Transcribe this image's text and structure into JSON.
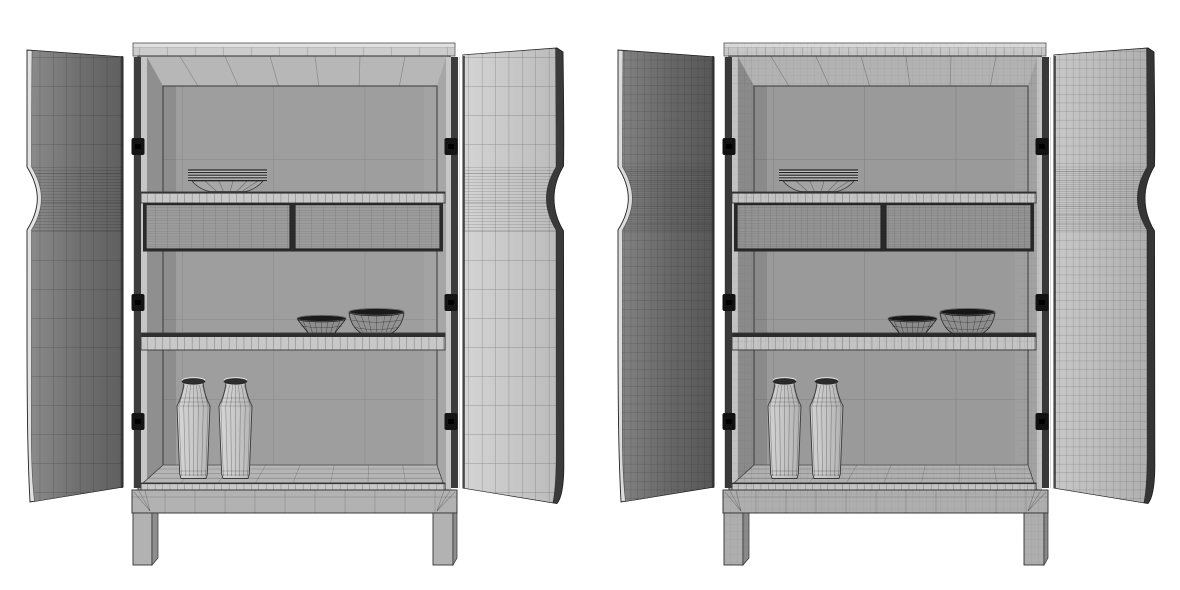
{
  "scene": {
    "title": "wireframe-3d-render-of-open-two-door-cabinet-two-views",
    "background": "#ffffff",
    "canvas": {
      "width": 1180,
      "height": 590
    },
    "objects": [
      "open two-door cabinet",
      "stacked plates",
      "small bowl",
      "large bowl",
      "two bottle vases",
      "two drawers",
      "base with legs"
    ],
    "views": [
      {
        "id": "cabA",
        "name": "cabinet-wireframe-left",
        "label": "left render (coarse wireframe)",
        "offset_x": 0,
        "mesh": {
          "door_w": 13.4,
          "door_h": 29,
          "dense_gap": 3,
          "door_line": "rgba(15,15,15,0.40)",
          "panel_w": 91.3,
          "panel_h": 80,
          "panel_line": "rgba(0,0,0,0.18)",
          "tick": 7.4,
          "cornice_tick": 28,
          "drawer_seam": 12,
          "drawer_line": "rgba(0,0,0,0.30)",
          "fine": 0
        },
        "colors": {
          "outline": "#2f2f2f",
          "cornice_top": "#e0e0e0",
          "cornice_face": "#cccccc",
          "carcass": "#b0b0b0",
          "bevel": "#b7b7b7",
          "jamb_front": "#c6c6c6",
          "reveal_left": "#8f8f8f",
          "reveal_right": "#a6a6a6",
          "panel": "#9e9e9e",
          "shelf_face": "#c8c8c8",
          "shelf_dark": "#2f2f2f",
          "drawer_face": "#9c9c9c",
          "drawer_slot": "#2b2b2b",
          "floor": "#b5b5b5",
          "edge_band": "#c9c9c9",
          "base": "#b2b2b2",
          "leg_side": "#8e8e8e",
          "hinge_gap": "#3d3d3d",
          "hinge_metal": "#141414",
          "hinge_highlight": "#d9d9d9",
          "door_left_grad": [
            "#8a8a8a",
            "#707070",
            "#5f5f5f"
          ],
          "door_right_grad": [
            "#d4d4d4",
            "#bcbcbc"
          ],
          "door_left_edge": "#e2e2e2",
          "door_right_edge": "#3a3a3a",
          "dish": "#a8a8a8",
          "dish_line": "#262626",
          "bowl_small": "#8e8e8e",
          "bowl_large": "#929292",
          "bowl_rim": "#1a1a1a",
          "vase_grad": [
            "#d6d6d6",
            "#c9c9c9",
            "#b5b5b5"
          ],
          "vase_line": "rgba(40,40,40,0.45)",
          "vase_mouth": "#2e2e2e",
          "line_soft": "rgba(0,0,0,0.25)"
        }
      },
      {
        "id": "cabB",
        "name": "cabinet-wireframe-right",
        "label": "right render (dense wireframe)",
        "offset_x": 591,
        "mesh": {
          "door_w": 6.7,
          "door_h": 8.6,
          "dense_gap": 2.2,
          "door_line": "rgba(20,20,20,0.32)",
          "panel_w": 91.3,
          "panel_h": 80,
          "panel_line": "rgba(0,0,0,0.20)",
          "tick": 7.4,
          "cornice_tick": 9.2,
          "drawer_seam": 6.2,
          "drawer_line": "rgba(0,0,0,0.28)",
          "fine": 7
        },
        "colors": {
          "outline": "#2c2c2c",
          "cornice_top": "#dcdcdc",
          "cornice_face": "#c7c7c7",
          "carcass": "#ababab",
          "bevel": "#b2b2b2",
          "jamb_front": "#c2c2c2",
          "reveal_left": "#8a8a8a",
          "reveal_right": "#a2a2a2",
          "panel": "#9a9a9a",
          "shelf_face": "#c4c4c4",
          "shelf_dark": "#2c2c2c",
          "drawer_face": "#949494",
          "drawer_slot": "#282828",
          "floor": "#b0b0b0",
          "edge_band": "#c4c4c4",
          "base": "#aeaeae",
          "leg_side": "#8a8a8a",
          "hinge_gap": "#383838",
          "hinge_metal": "#121212",
          "hinge_highlight": "#d4d4d4",
          "door_left_grad": [
            "#828282",
            "#686868",
            "#575757"
          ],
          "door_right_grad": [
            "#c8c8c8",
            "#b0b0b0"
          ],
          "door_left_edge": "#dcdcdc",
          "door_right_edge": "#353535",
          "dish": "#a4a4a4",
          "dish_line": "#222222",
          "bowl_small": "#8a8a8a",
          "bowl_large": "#8e8e8e",
          "bowl_rim": "#161616",
          "vase_grad": [
            "#d2d2d2",
            "#c5c5c5",
            "#b1b1b1"
          ],
          "vase_line": "rgba(35,35,35,0.45)",
          "vase_mouth": "#2a2a2a",
          "line_soft": "rgba(0,0,0,0.28)"
        }
      }
    ]
  }
}
